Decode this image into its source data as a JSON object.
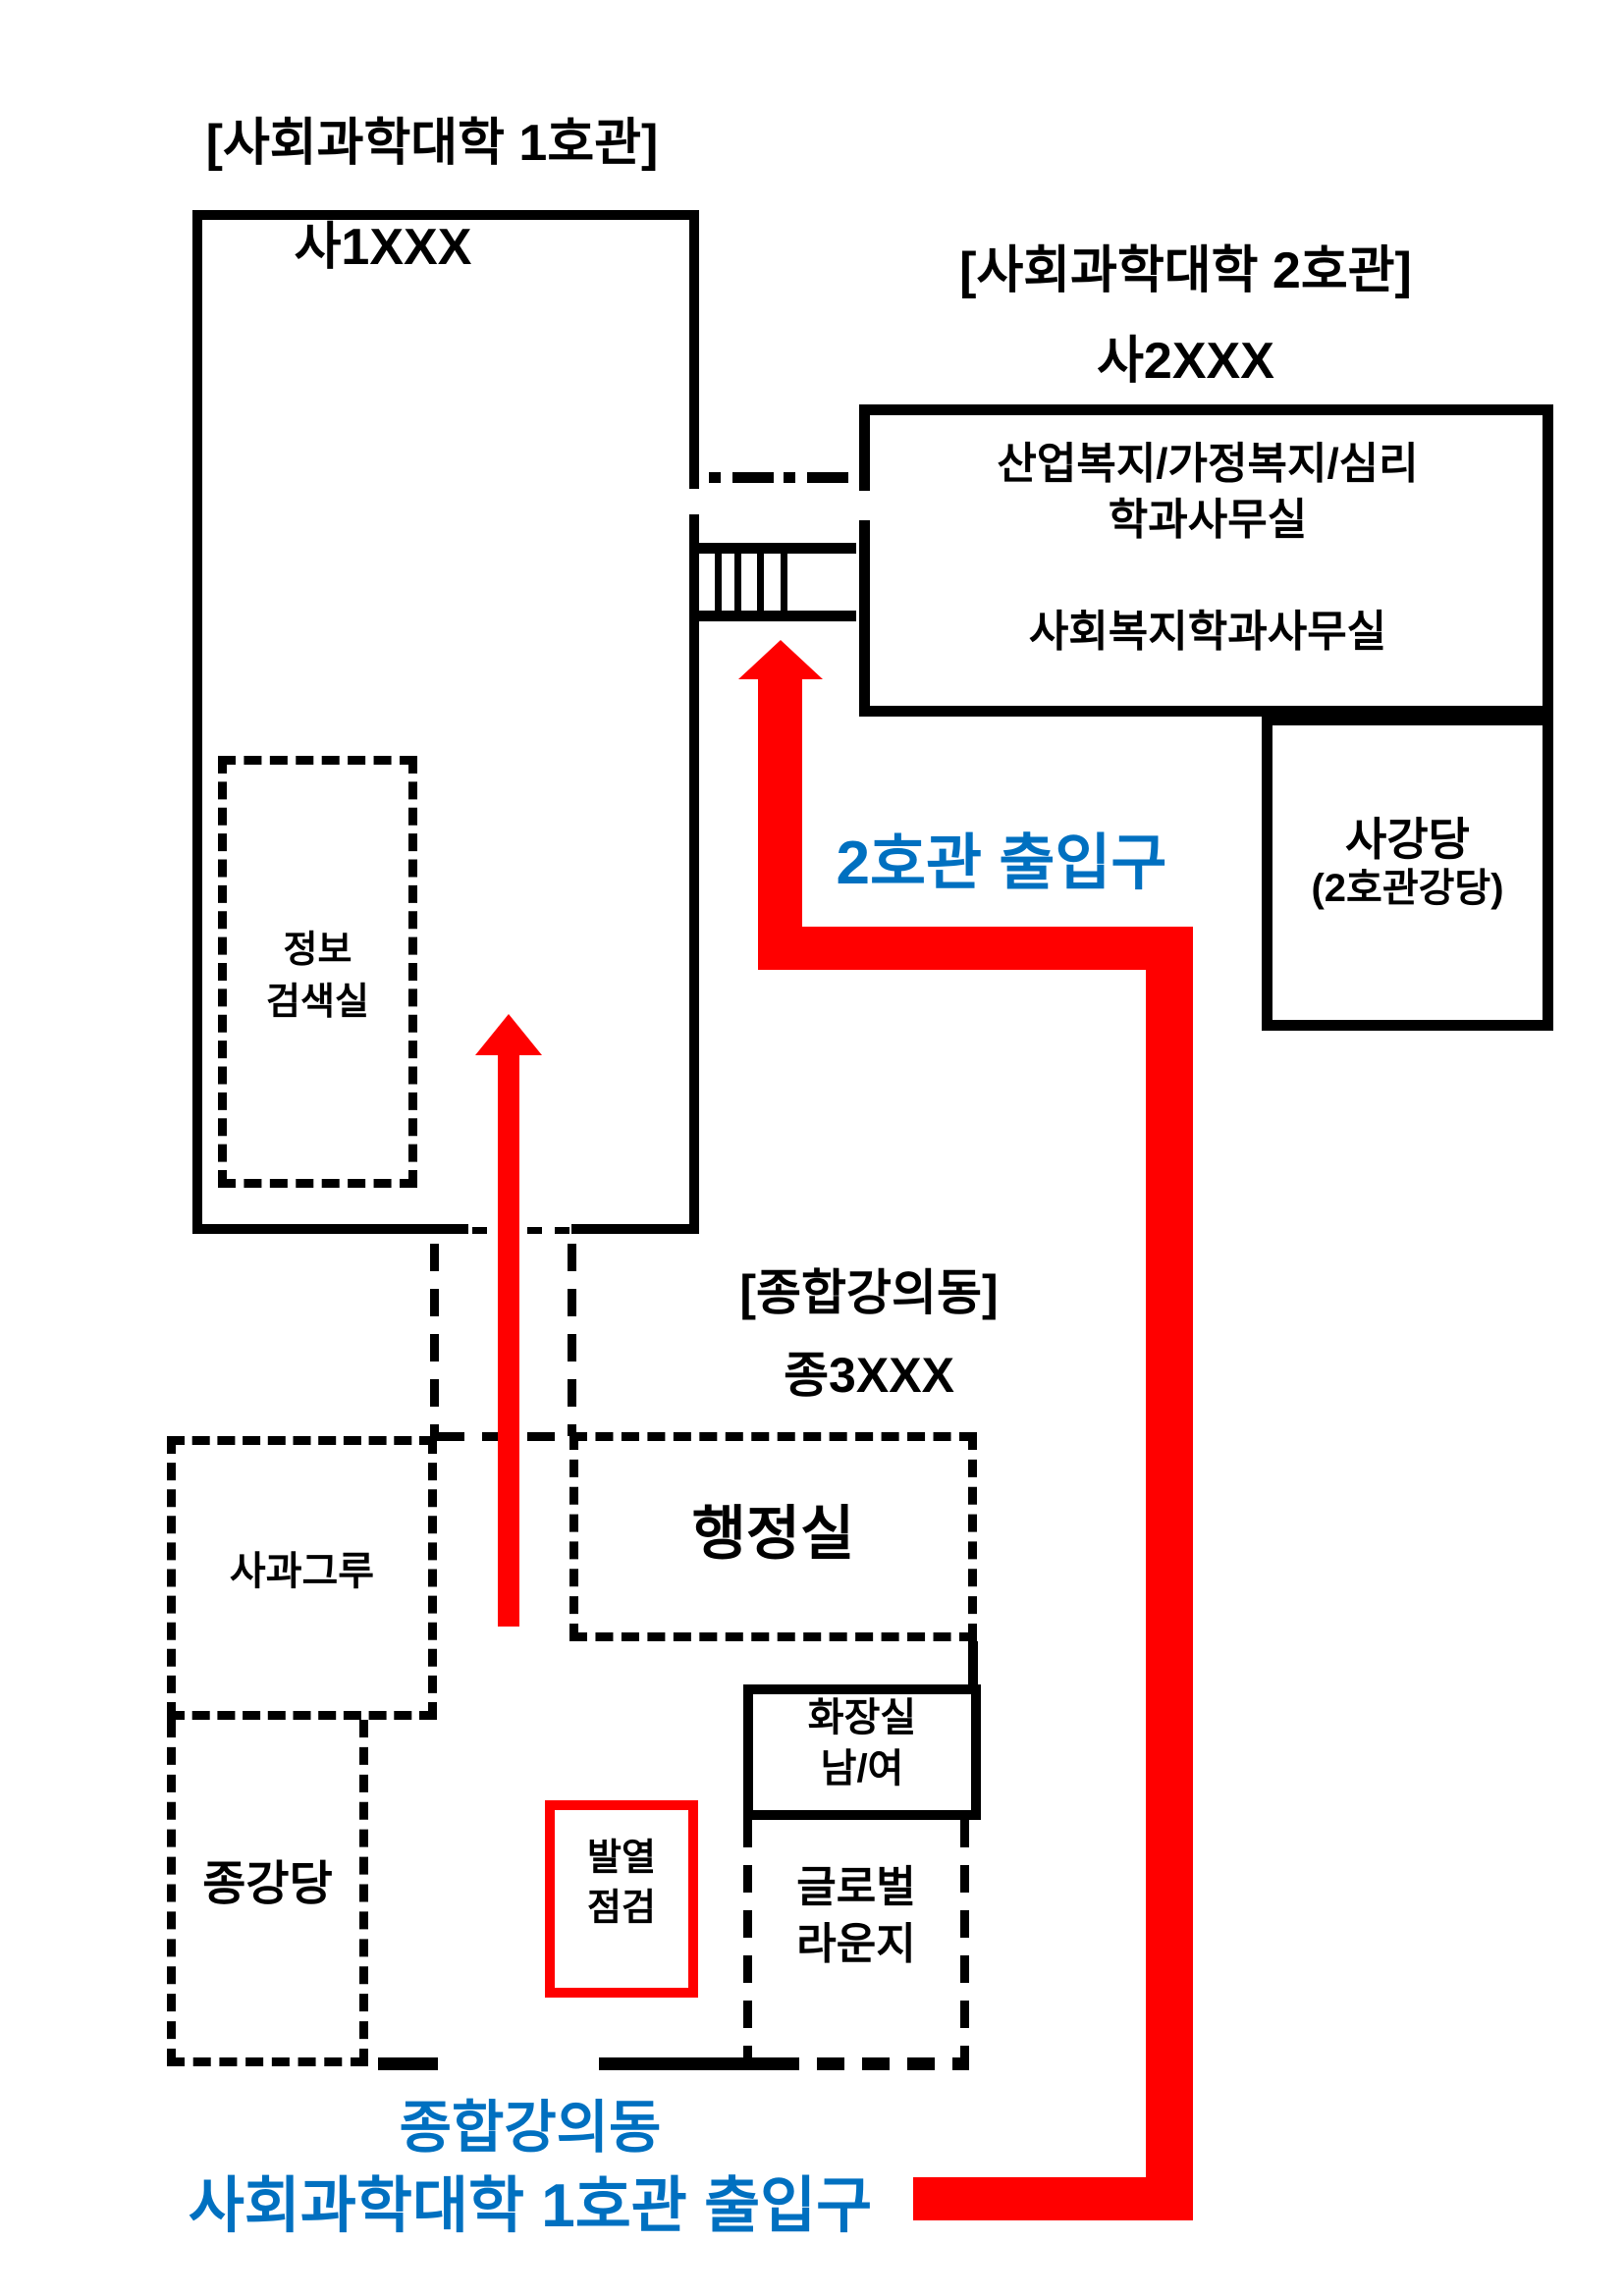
{
  "colors": {
    "arrow_red": "#ff0000",
    "label_blue": "#0070c0",
    "line_black": "#000000"
  },
  "building1": {
    "title": "[사회과학대학 1호관]",
    "code": "사1XXX",
    "info_room_line1": "정보",
    "info_room_line2": "검색실"
  },
  "building2": {
    "title": "[사회과학대학 2호관]",
    "code": "사2XXX",
    "dept_office_line1": "산업복지/가정복지/심리",
    "dept_office_line2": "학과사무실",
    "welfare_office": "사회복지학과사무실",
    "auditorium_line1": "사강당",
    "auditorium_line2": "(2호관강당)"
  },
  "lecture_building": {
    "title": "[종합강의동]",
    "code": "종3XXX",
    "admin_office": "행정실",
    "grove_room": "사과그루",
    "auditorium": "종강당",
    "restroom_line1": "화장실",
    "restroom_line2": "남/여",
    "fever_check_line1": "발열",
    "fever_check_line2": "점검",
    "global_lounge_line1": "글로벌",
    "global_lounge_line2": "라운지"
  },
  "annotations": {
    "bldg2_entrance": "2호관 출입구",
    "main_entrance_line1": "종합강의동",
    "main_entrance_line2": "사회과학대학 1호관 출입구"
  }
}
